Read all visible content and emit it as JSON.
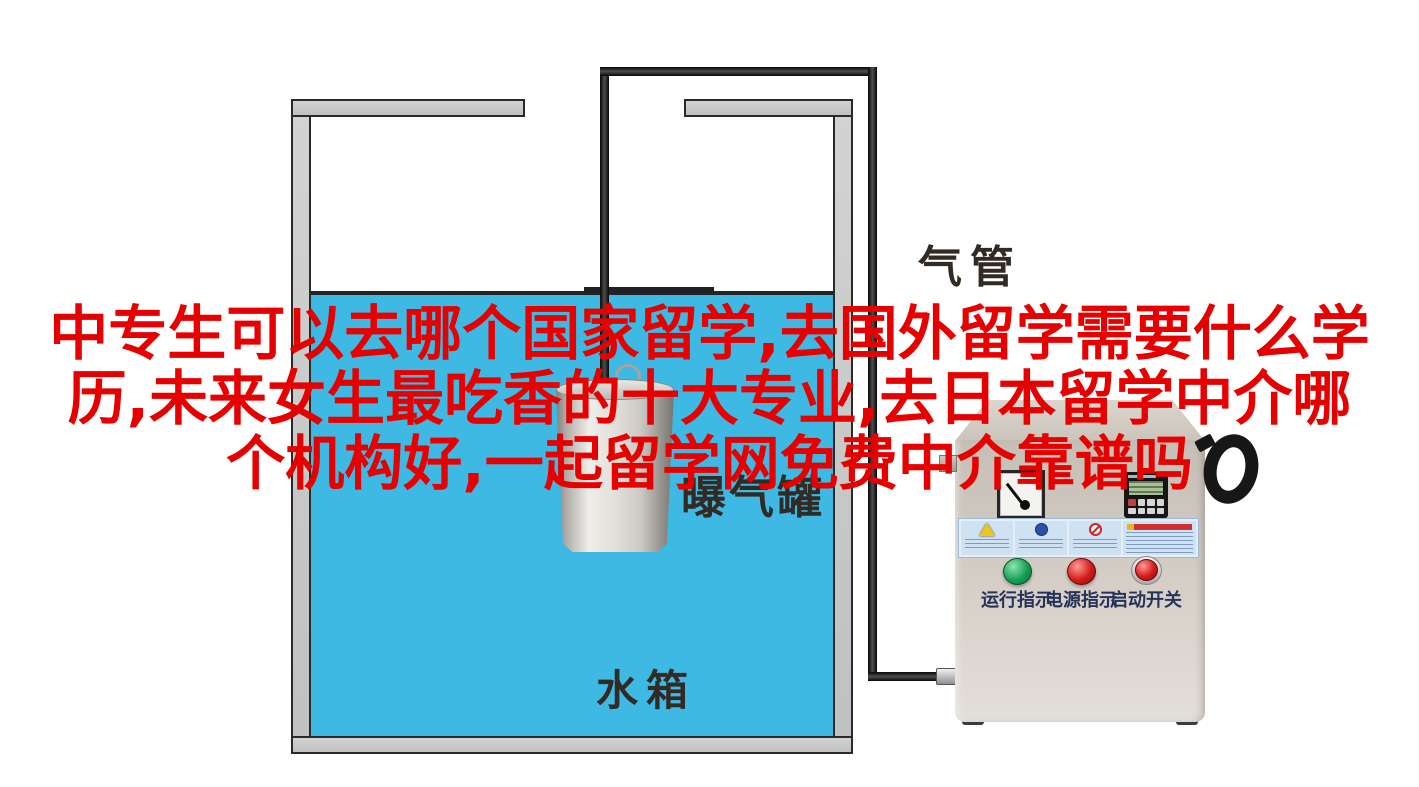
{
  "overlay_title": {
    "color": "#e60000",
    "lines": [
      "中专生可以去哪个国家留学,去国外留学需要什么学",
      "历,未来女生最吃香的十大专业,去日本留学中介哪",
      "个机构好,一起留学网免费中介靠谱吗"
    ]
  },
  "diagram": {
    "labels": {
      "air_pipe": "气管",
      "aeration_canister": "曝气罐",
      "water_tank": "水箱"
    },
    "colors": {
      "water": "#3db9e3",
      "tank_wall": "#c5c7c7",
      "pipe": "#1c1a18",
      "machine_body": "#d0c9c0",
      "indicator_green": "#17a155",
      "indicator_red": "#d31b1b"
    }
  },
  "machine_panel": {
    "indicators": [
      {
        "label": "运行指示",
        "color": "green"
      },
      {
        "label": "电源指示",
        "color": "red"
      },
      {
        "label": "启动开关",
        "color": "red"
      }
    ]
  }
}
